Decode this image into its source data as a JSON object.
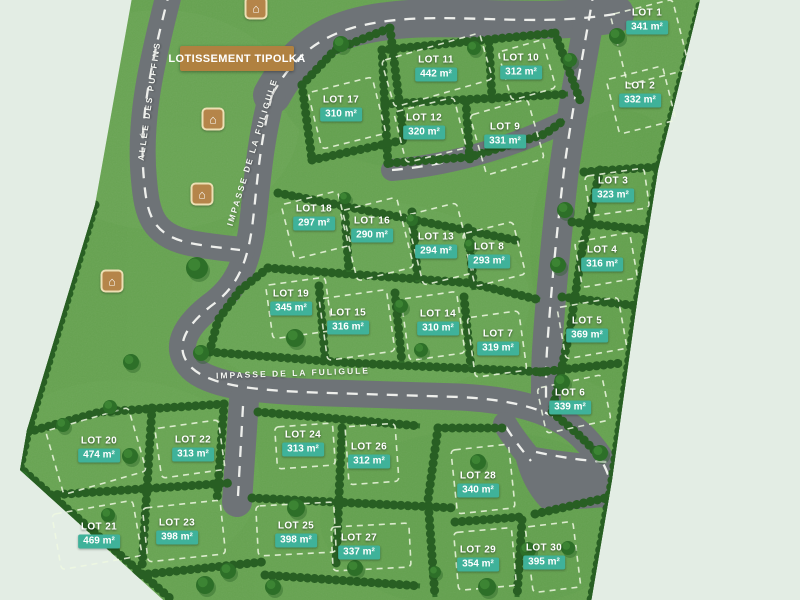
{
  "map": {
    "title_banner": "LOTISSEMENT TIPOLKA",
    "road_labels": [
      {
        "name": "ALLÉE DES PUFFINS"
      },
      {
        "name": "IMPASSE DE LA FULIGULE"
      },
      {
        "name": "IMPASSE DE LA FULIGULE"
      }
    ],
    "house_icon_glyph": "⌂",
    "colors": {
      "background": "#e3ede4",
      "grass": "#66a350",
      "hedge": "#2f6b29",
      "tree": "#2d6f28",
      "road": "#6e7377",
      "road_dash": "#f4f6f2",
      "area_badge": "#3fb29a",
      "banner": "#b08140",
      "lot_boundary_dash": "#eef8e2"
    },
    "lots": [
      {
        "id": 1,
        "label": "LOT 1",
        "area": "341 m²"
      },
      {
        "id": 2,
        "label": "LOT 2",
        "area": "332 m²"
      },
      {
        "id": 3,
        "label": "LOT 3",
        "area": "323 m²"
      },
      {
        "id": 4,
        "label": "LOT 4",
        "area": "316 m²"
      },
      {
        "id": 5,
        "label": "LOT 5",
        "area": "369 m²"
      },
      {
        "id": 6,
        "label": "LOT 6",
        "area": "339 m²"
      },
      {
        "id": 7,
        "label": "LOT 7",
        "area": "319 m²"
      },
      {
        "id": 8,
        "label": "LOT 8",
        "area": "293 m²"
      },
      {
        "id": 9,
        "label": "LOT 9",
        "area": "331 m²"
      },
      {
        "id": 10,
        "label": "LOT 10",
        "area": "312 m²"
      },
      {
        "id": 11,
        "label": "LOT 11",
        "area": "442 m²"
      },
      {
        "id": 12,
        "label": "LOT 12",
        "area": "320 m²"
      },
      {
        "id": 13,
        "label": "LOT 13",
        "area": "294 m²"
      },
      {
        "id": 14,
        "label": "LOT 14",
        "area": "310 m²"
      },
      {
        "id": 15,
        "label": "LOT 15",
        "area": "316 m²"
      },
      {
        "id": 16,
        "label": "LOT 16",
        "area": "290 m²"
      },
      {
        "id": 17,
        "label": "LOT 17",
        "area": "310 m²"
      },
      {
        "id": 18,
        "label": "LOT 18",
        "area": "297 m²"
      },
      {
        "id": 19,
        "label": "LOT 19",
        "area": "345 m²"
      },
      {
        "id": 20,
        "label": "LOT 20",
        "area": "474 m²"
      },
      {
        "id": 21,
        "label": "LOT 21",
        "area": "469 m²"
      },
      {
        "id": 22,
        "label": "LOT 22",
        "area": "313 m²"
      },
      {
        "id": 23,
        "label": "LOT 23",
        "area": "398 m²"
      },
      {
        "id": 24,
        "label": "LOT 24",
        "area": "313 m²"
      },
      {
        "id": 25,
        "label": "LOT 25",
        "area": "398 m²"
      },
      {
        "id": 26,
        "label": "LOT 26",
        "area": "312 m²"
      },
      {
        "id": 27,
        "label": "LOT 27",
        "area": "337 m²"
      },
      {
        "id": 28,
        "label": "LOT 28",
        "area": "340 m²"
      },
      {
        "id": 29,
        "label": "LOT 29",
        "area": "354 m²"
      },
      {
        "id": 30,
        "label": "LOT 30",
        "area": "395 m²"
      }
    ]
  }
}
